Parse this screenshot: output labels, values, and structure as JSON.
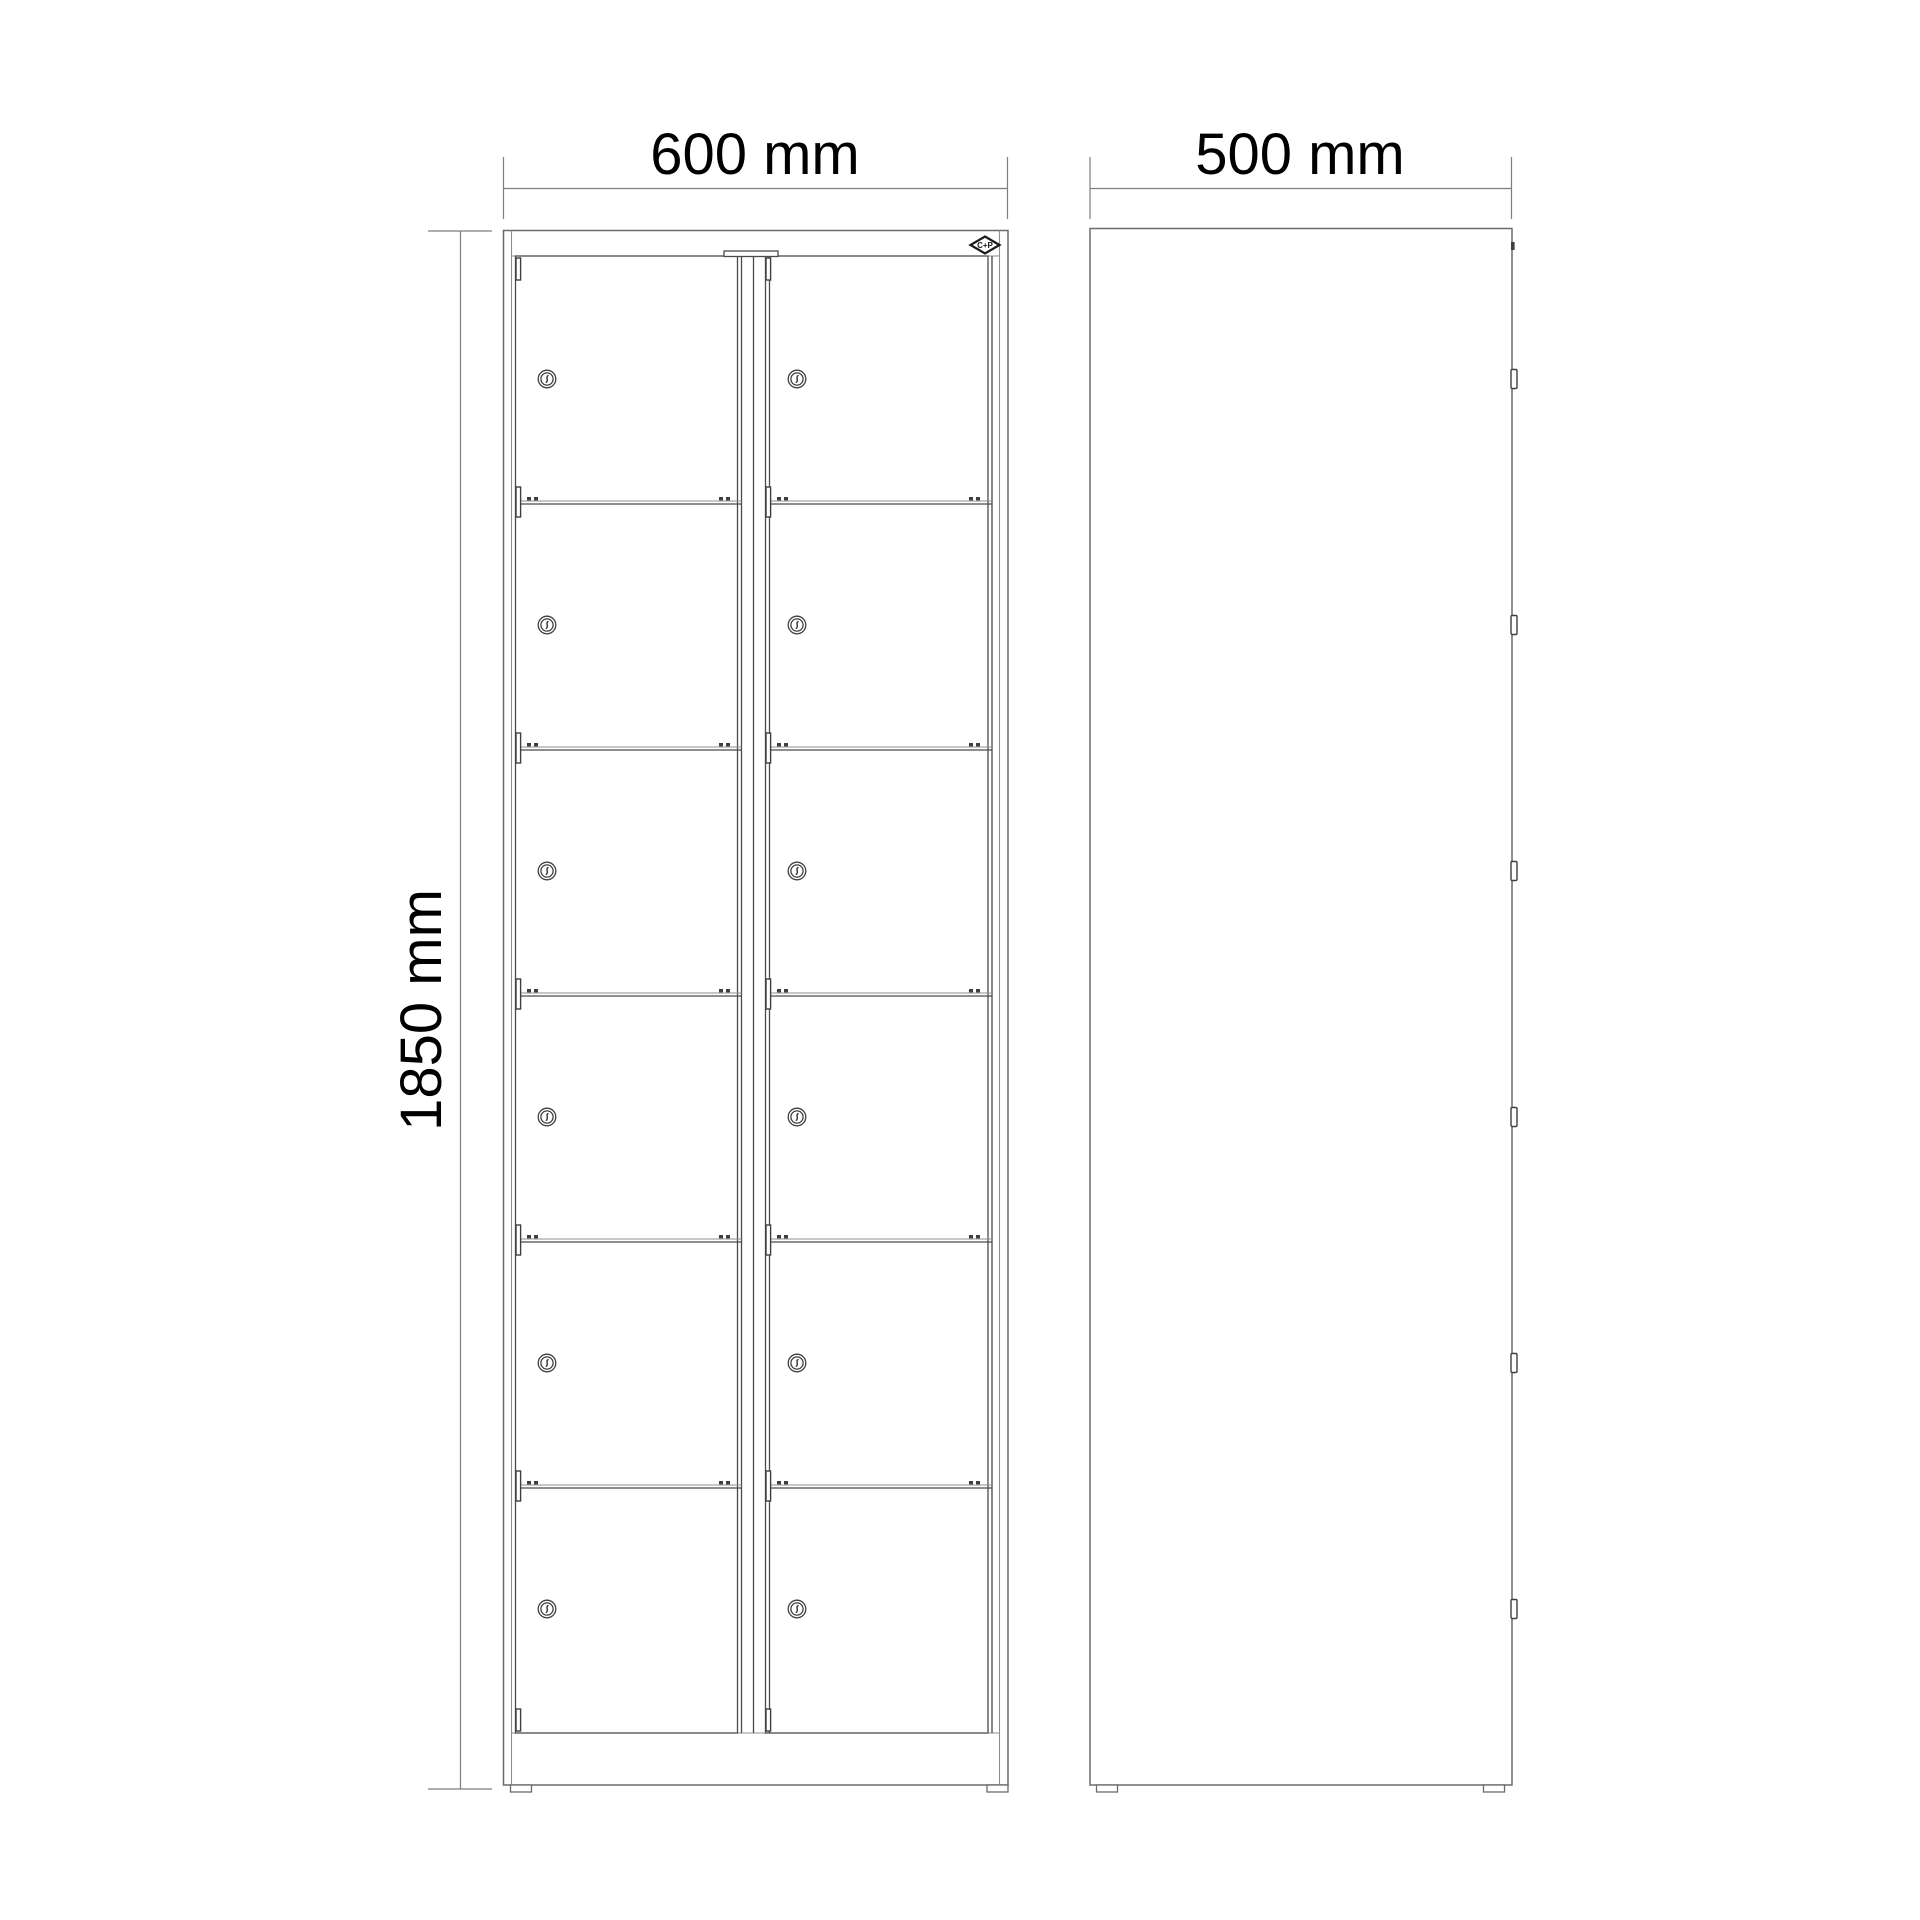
{
  "drawing": {
    "type": "technical-drawing",
    "subject": "metal locker cabinet with 12 compartments, front and side elevation",
    "views": {
      "front": {
        "label": "front view",
        "columns": 2,
        "rows": 6,
        "compartments": 12,
        "locks": 12
      },
      "side": {
        "label": "side view",
        "lock_tabs": 6
      }
    },
    "dimensions": {
      "width": {
        "label": "600 mm"
      },
      "depth": {
        "label": "500 mm"
      },
      "height": {
        "label": "1850 mm"
      }
    },
    "logo": {
      "label": "C+P"
    },
    "colors": {
      "background": "#ffffff",
      "line": "#6b6b6b",
      "line_dark": "#3f3f3f",
      "dimension_line": "#7d7d7d",
      "text": "#000000"
    }
  }
}
